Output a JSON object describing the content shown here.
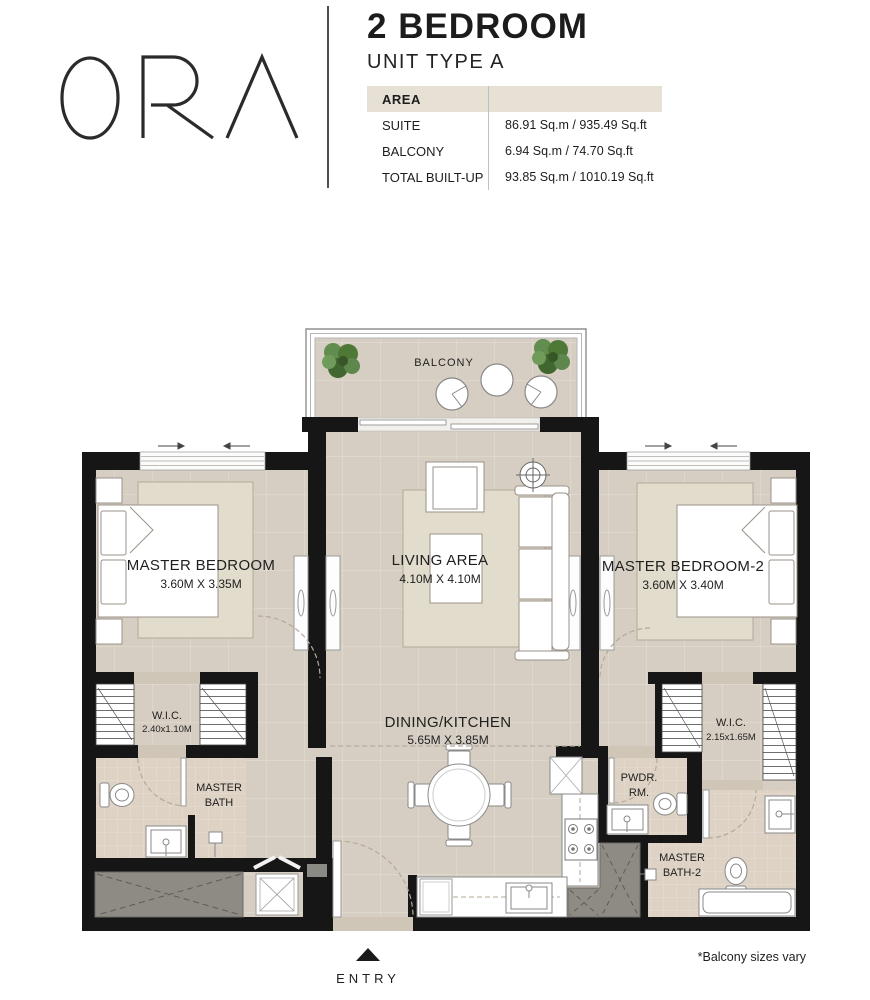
{
  "brand": {
    "logo_text": "ORA"
  },
  "header": {
    "title": "2 BEDROOM",
    "subtitle": "UNIT TYPE A",
    "area_table": {
      "header_label": "AREA",
      "rows": [
        {
          "label": "SUITE",
          "value": "86.91 Sq.m / 935.49 Sq.ft"
        },
        {
          "label": "BALCONY",
          "value": "6.94 Sq.m / 74.70 Sq.ft"
        },
        {
          "label": "TOTAL BUILT-UP",
          "value": "93.85 Sq.m / 1010.19 Sq.ft"
        }
      ]
    }
  },
  "floorplan": {
    "balcony": {
      "label": "BALCONY"
    },
    "master_bedroom": {
      "label": "MASTER BEDROOM",
      "dims": "3.60M X 3.35M"
    },
    "living_area": {
      "label": "LIVING AREA",
      "dims": "4.10M X 4.10M"
    },
    "master_bedroom_2": {
      "label": "MASTER BEDROOM-2",
      "dims": "3.60M X 3.40M"
    },
    "wic_1": {
      "label": "W.I.C.",
      "dims": "2.40x1.10M"
    },
    "dining_kitchen": {
      "label": "DINING/KITCHEN",
      "dims": "5.65M X 3.85M"
    },
    "master_bath": {
      "label_line1": "MASTER",
      "label_line2": "BATH"
    },
    "pwdr_rm": {
      "label_line1": "PWDR.",
      "label_line2": "RM."
    },
    "wic_2": {
      "label": "W.I.C.",
      "dims": "2.15x1.65M"
    },
    "master_bath_2": {
      "label_line1": "MASTER",
      "label_line2": "BATH-2"
    },
    "entry": {
      "label": "ENTRY"
    },
    "footnote": "*Balcony sizes vary"
  },
  "colors": {
    "wall": "#161616",
    "floor": "#d6cec2",
    "bath_tile": "#ddd2c4",
    "rug": "#e2dccd",
    "shaft_gray": "#8e8a84",
    "table_header_beige": "#e7e0d4",
    "table_divider_blue": "#b7c3c9",
    "plant_green": "#4a7a39",
    "threshold": "#d0c6b8"
  }
}
